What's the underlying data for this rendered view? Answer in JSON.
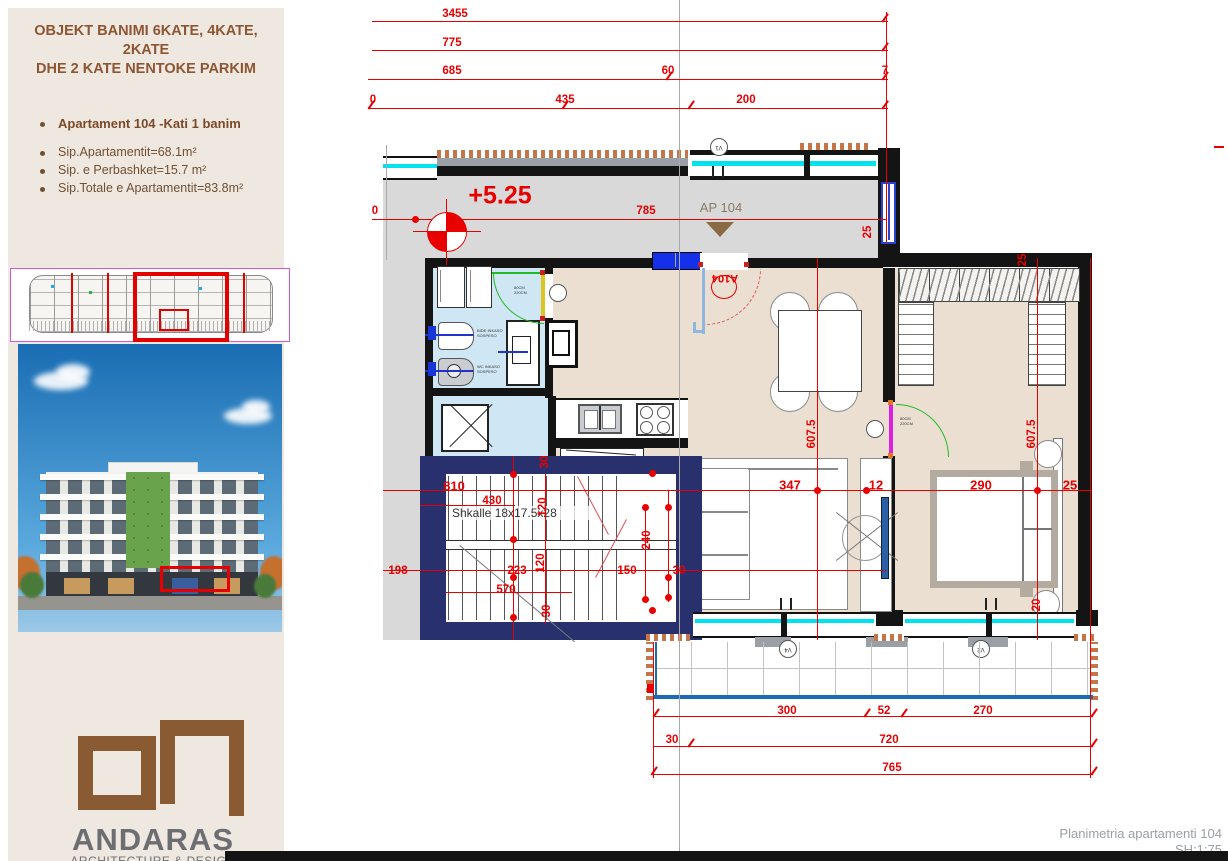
{
  "sidebar": {
    "title_line1": "OBJEKT BANIMI 6KATE, 4KATE, 2KATE",
    "title_line2": "DHE 2 KATE NENTOKE PARKIM",
    "apartment_heading": "Apartament  104  -Kati 1 banim",
    "bullets": [
      "Sip.Apartamentit=68.1m²",
      "Sip. e Perbashket=15.7 m²",
      "Sip.Totale e Apartamentit=83.8m²"
    ],
    "logo": {
      "name": "ANDARAS",
      "tagline": "ARCHITECTURE & DESIGN"
    }
  },
  "plan": {
    "level_label": "+5.25",
    "apartment_tag": "AP 104",
    "entry_door_tag": "A104",
    "stairs_label": "Shkalle 18x17.5x28",
    "window_tags": {
      "top": "V1",
      "living": "V4",
      "bedroom": "V2"
    },
    "fixtures": {
      "bide_line1": "BIDE INKASO",
      "bide_line2": "SOSPESO",
      "wc_line1": "WC INKASO",
      "wc_line2": "SOSPESO"
    },
    "door_size_line1": "80CM",
    "door_size_line2": "220CM"
  },
  "dimensions": {
    "labels": [
      {
        "t": "3455",
        "x": 455,
        "y": 14
      },
      {
        "t": "775",
        "x": 452,
        "y": 43
      },
      {
        "t": "685",
        "x": 452,
        "y": 71
      },
      {
        "t": "60",
        "x": 668,
        "y": 71
      },
      {
        "t": "7",
        "x": 885,
        "y": 71
      },
      {
        "t": "0",
        "x": 373,
        "y": 100
      },
      {
        "t": "435",
        "x": 565,
        "y": 100
      },
      {
        "t": "200",
        "x": 746,
        "y": 100
      },
      {
        "t": "0",
        "x": 375,
        "y": 211
      },
      {
        "t": "785",
        "x": 646,
        "y": 211
      },
      {
        "t": "25",
        "x": 868,
        "y": 232,
        "rot": 1
      },
      {
        "t": "25",
        "x": 1023,
        "y": 260,
        "rot": 1
      },
      {
        "t": "607.5",
        "x": 812,
        "y": 434,
        "rot": 1
      },
      {
        "t": "607.5",
        "x": 1032,
        "y": 434,
        "rot": 1
      },
      {
        "t": "810",
        "x": 454,
        "y": 486,
        "s": 1
      },
      {
        "t": "430",
        "x": 492,
        "y": 501
      },
      {
        "t": "347",
        "x": 790,
        "y": 485,
        "s": 1
      },
      {
        "t": "12",
        "x": 876,
        "y": 485,
        "s": 1
      },
      {
        "t": "290",
        "x": 981,
        "y": 485,
        "s": 1
      },
      {
        "t": "25",
        "x": 1070,
        "y": 485,
        "s": 1
      },
      {
        "t": "30",
        "x": 545,
        "y": 462,
        "rot": 1
      },
      {
        "t": "120",
        "x": 543,
        "y": 507,
        "rot": 1
      },
      {
        "t": "120",
        "x": 541,
        "y": 563,
        "rot": 1
      },
      {
        "t": "240",
        "x": 647,
        "y": 540,
        "rot": 1
      },
      {
        "t": "198",
        "x": 398,
        "y": 571
      },
      {
        "t": "223",
        "x": 517,
        "y": 571
      },
      {
        "t": "150",
        "x": 627,
        "y": 571
      },
      {
        "t": "30",
        "x": 679,
        "y": 571
      },
      {
        "t": "570",
        "x": 506,
        "y": 590
      },
      {
        "t": "30",
        "x": 547,
        "y": 611,
        "rot": 1
      },
      {
        "t": "20",
        "x": 1037,
        "y": 605,
        "rot": 1
      },
      {
        "t": "300",
        "x": 787,
        "y": 711
      },
      {
        "t": "52",
        "x": 884,
        "y": 711
      },
      {
        "t": "270",
        "x": 983,
        "y": 711
      },
      {
        "t": "30",
        "x": 672,
        "y": 740
      },
      {
        "t": "720",
        "x": 889,
        "y": 740
      },
      {
        "t": "765",
        "x": 892,
        "y": 768
      }
    ]
  },
  "footer": {
    "title": "Planimetria apartamenti 104",
    "scale": "SH:1:75"
  }
}
